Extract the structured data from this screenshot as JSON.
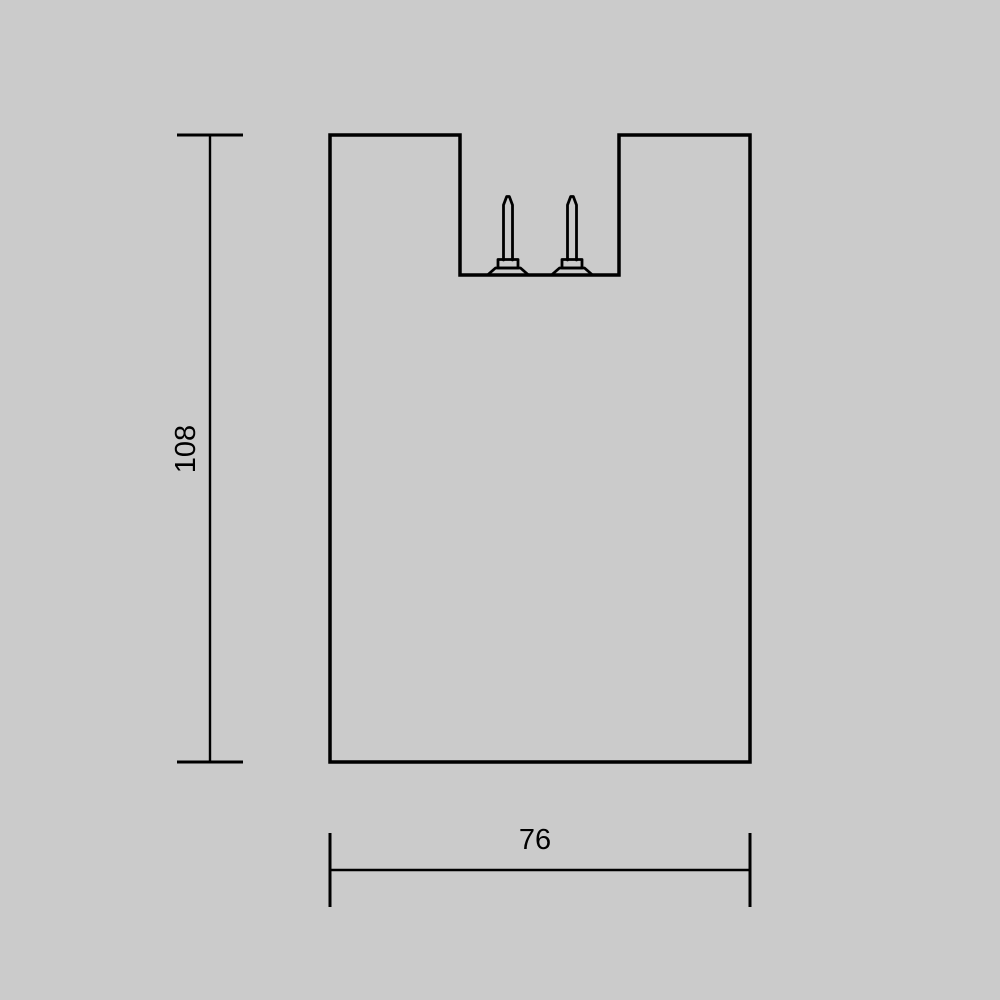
{
  "canvas": {
    "background": "#cbcbcb",
    "line_color": "#000000",
    "text_color": "#000000"
  },
  "drawing": {
    "kind": "product-dimension-drawing",
    "dimensions": {
      "height": {
        "label": "108"
      },
      "width": {
        "label": "76"
      }
    }
  }
}
